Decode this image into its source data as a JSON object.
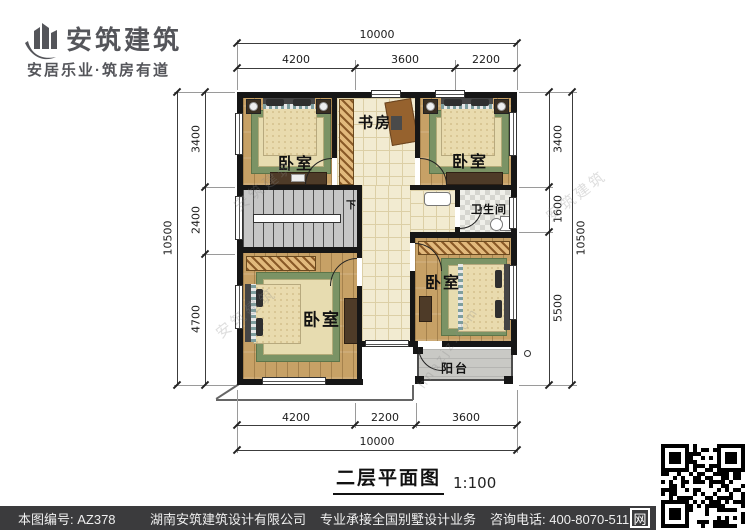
{
  "brand": {
    "name": "安筑建筑",
    "tagline": "安居乐业·筑房有道"
  },
  "plan": {
    "title": "二层平面图",
    "scale": "1:100",
    "rooms": {
      "study": "书房",
      "bedroom_tl": "卧室",
      "bedroom_tr": "卧室",
      "bedroom_bl": "卧室",
      "bedroom_br": "卧室",
      "bathroom": "卫生间",
      "balcony": "阳台",
      "stair_down": "下"
    },
    "dimensions": {
      "top_total": "10000",
      "top_segments": [
        "4200",
        "3600",
        "2200"
      ],
      "bottom_segments": [
        "4200",
        "2200",
        "3600"
      ],
      "bottom_total": "10000",
      "left_total": "10500",
      "left_segments": [
        "3400",
        "2400",
        "4700"
      ],
      "right_total": "10500",
      "right_segments": [
        "3400",
        "1600",
        "5500"
      ]
    }
  },
  "watermark": {
    "brand": "安筑建筑",
    "site": "hnazjz.com"
  },
  "footer": {
    "drawing_no": "本图编号: AZ378",
    "company": "湖南安筑建筑设计有限公司",
    "service": "专业承接全国别墅设计业务",
    "phone": "咨询电话: 400-8070-511",
    "web_badge": "网"
  },
  "colors": {
    "accent_dark": "#54555a",
    "footer_bg": "#3b3b3d",
    "wall": "#161616",
    "wood_floor": "#c7a166",
    "corridor_tile": "#f2ebd1",
    "rug_green": "#7b9365"
  }
}
